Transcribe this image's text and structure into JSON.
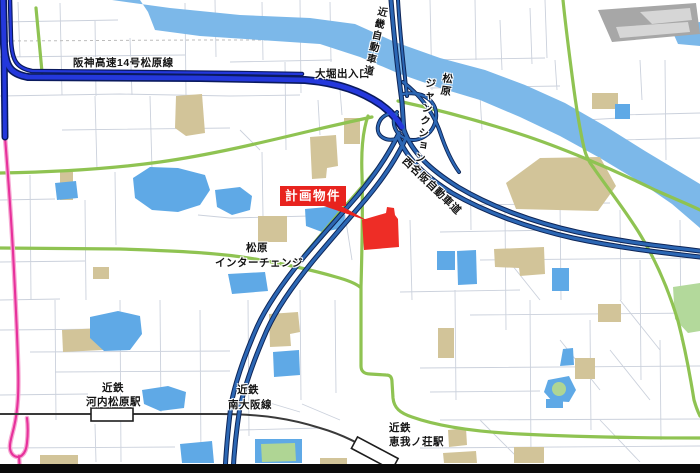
{
  "meta": {
    "width": 700,
    "height": 473,
    "description": "計画物件位置図 松原ジャンクション周辺地図"
  },
  "palette": {
    "street": "#CBD1DC",
    "boundary": "#BDBDBD",
    "river": "#7CB8E9",
    "pond": "#5FA9E6",
    "park": "#B3D99B",
    "building_tan": "#D2C499",
    "building_gray": "#A7A7A7",
    "road_green": "#8FC352",
    "rail": "#3A3A3A",
    "pink_casing": "#F6ABD4",
    "pink_core": "#E7309B",
    "expwy_casing": "#0E2557",
    "expwy_fill": "#2C67B4",
    "hanshin_casing": "#0A1A5E",
    "hanshin_fill": "#2438DC",
    "property_red": "#EE2D26",
    "callout_red": "#E8231E",
    "bottom_bar": "#0A0A0A"
  },
  "callout": {
    "text": "計画物件"
  },
  "map": {
    "labels": [
      {
        "name": "hanshin-route-label",
        "text": "阪神高速14号松原線",
        "x": 73,
        "y": 57,
        "size": 10.5
      },
      {
        "name": "ohori-exit-label",
        "text": "大堀出入口",
        "x": 315,
        "y": 68,
        "size": 10.5
      },
      {
        "name": "kinki-expressway-label",
        "text": "近畿自動車道",
        "x": 376,
        "y": 5,
        "size": 10,
        "rot": 13,
        "cls": "vert"
      },
      {
        "name": "matsubara-junction-label-line1",
        "text": "松原",
        "x": 442,
        "y": 72,
        "size": 10.5,
        "rot": 8,
        "cls": "vert"
      },
      {
        "name": "matsubara-junction-label-line2",
        "text": "ジャンクション",
        "x": 425,
        "y": 77,
        "size": 10.5,
        "rot": 8,
        "cls": "vert"
      },
      {
        "name": "nishimeihan-expressway-label",
        "text": "西名阪自動車道",
        "x": 408,
        "y": 155,
        "size": 10.5,
        "rot": 44
      },
      {
        "name": "matsubara-ic-label-line1",
        "text": "松原",
        "x": 246,
        "y": 242,
        "size": 10.5
      },
      {
        "name": "matsubara-ic-label-line2",
        "text": "インターチェンジ",
        "x": 215,
        "y": 257,
        "size": 10.5
      },
      {
        "name": "kintetsu-kawachi-label-line1",
        "text": "近鉄",
        "x": 102,
        "y": 382,
        "size": 10.5
      },
      {
        "name": "kintetsu-kawachi-label-line2",
        "text": "河内松原駅",
        "x": 86,
        "y": 396,
        "size": 10.5
      },
      {
        "name": "minami-osaka-line-label-line1",
        "text": "近鉄",
        "x": 237,
        "y": 384,
        "size": 10.5
      },
      {
        "name": "minami-osaka-line-label-line2",
        "text": "南大阪線",
        "x": 228,
        "y": 399,
        "size": 10.5
      },
      {
        "name": "kintetsu-eganosho-label-line1",
        "text": "近鉄",
        "x": 389,
        "y": 422,
        "size": 10.5
      },
      {
        "name": "kintetsu-eganosho-label-line2",
        "text": "恵我ノ荘駅",
        "x": 389,
        "y": 436,
        "size": 10.5
      }
    ],
    "layers": [
      {
        "name": "street-grid",
        "attrs": {
          "stroke": "#CBD1DC",
          "stroke-width": "0.9",
          "fill": "none"
        },
        "shapes": [
          {
            "d": "M18,2 L20,57 M60,3 L62,95 M95,20 L96,96 M130,38 L132,95 M185,3 L186,95 M215,0 L216,57 M0,22 L118,20 M0,57 L185,55 M0,96 L120,94 L230,96 M62,130 L230,128 M95,96 L97,170 M150,96 L152,170 M230,25 L330,24 M262,2 L263,60 M300,0 L301,93 M230,62 L332,60 M330,2 L331,62 M230,96 L300,95"
          },
          {
            "d": "M0,200 L55,199 M30,175 L31,300 M85,200 L86,300 M0,262 L85,261 M115,172 L116,245 M0,300 L60,299 M230,218 L310,216 M262,152 L263,217 M285,62 L286,150 M198,215 L230,218 M240,130 L260,150"
          },
          {
            "d": "M0,330 L120,329 M55,300 L56,420 M120,300 L121,462 M30,352 L230,351 M160,300 L161,412 M55,372 L230,371 M0,395 L88,394 M200,310 L201,462 M0,448 L175,447 M95,424 L96,462 M248,300 L249,436 M240,430 L320,428 M302,404 L340,420 M260,400 L300,412"
          },
          {
            "d": "M300,290 L301,400 M335,300 L336,393 M345,215 L352,260 M410,220 L412,300 M340,90 L342,115 M318,100 L320,135"
          },
          {
            "d": "M420,60 L545,58 M430,0 L432,90 M475,0 L476,60 M430,88 L560,86 M530,8 L532,64 M500,20 L502,70 M545,0 L547,58 M620,115 L700,113 M665,60 L666,160 M620,140 L700,138 M585,120 L620,118 M480,95 L482,130 M555,60 L557,90 M640,60 L642,100"
          },
          {
            "d": "M470,130 L471,230 M505,210 L506,330 M470,205 L610,203 M440,232 L560,230 M560,200 L561,300 M480,260 L700,258 M620,210 L621,300 M400,292 L520,290 M470,315 L700,313 M455,290 L456,400 M640,260 L641,380 M680,220 L681,340 M590,320 L591,430 M530,300 L531,460"
          },
          {
            "d": "M420,368 L700,366 M430,392 L540,391 M440,420 L700,419 M420,448 L700,446 M660,340 L661,440 M500,250 L540,300 M560,340 L600,390 M620,300 L660,350 M480,420 L520,460 M600,420 L640,462 M610,350 L650,400"
          }
        ]
      },
      {
        "name": "boundary-line",
        "attrs": {
          "stroke": "#BDBDBD",
          "stroke-width": "1",
          "fill": "none"
        },
        "shapes": [
          {
            "d": "M0,41 L200,40 L356,40",
            "stroke-dasharray": "3 3"
          }
        ]
      },
      {
        "name": "river",
        "attrs": {
          "fill": "#7CB8E9",
          "stroke": "none"
        },
        "shapes": [
          {
            "d": "M112,0 L170,8 L240,15 L310,18 L355,24 L395,42 L440,58 L485,70 L525,85 L565,103 L605,126 L645,151 L680,172 L700,184 L700,228 L672,204 L640,182 L600,158 L560,136 L520,117 L480,100 L440,88 L400,74 L360,57 L320,44 L260,40 L200,36 L155,30 L148,12 L140,0 Z"
          },
          {
            "d": "M670,26 L700,22 L700,46 L678,44 Z"
          }
        ]
      },
      {
        "name": "park-areas",
        "attrs": {
          "fill": "#B3D99B",
          "stroke": "none"
        },
        "shapes": [
          {
            "d": "M673,287 L700,283 L700,331 L688,333 L675,319 Z"
          }
        ]
      },
      {
        "name": "buildings-tan",
        "attrs": {
          "fill": "#D2C499",
          "stroke": "none"
        },
        "shapes": [
          {
            "d": "M176,96 L202,94 L205,133 L186,136 L175,128 Z"
          },
          {
            "t": "rect",
            "x": 60,
            "y": 172,
            "width": 13,
            "height": 28
          },
          {
            "d": "M310,137 L336,135 L338,166 L327,168 L326,178 L312,179 Z"
          },
          {
            "t": "rect",
            "x": 344,
            "y": 118,
            "width": 16,
            "height": 26
          },
          {
            "t": "rect",
            "x": 592,
            "y": 93,
            "width": 26,
            "height": 16
          },
          {
            "d": "M506,183 L540,158 L600,157 L616,186 L598,211 L516,209 Z"
          },
          {
            "t": "rect",
            "x": 93,
            "y": 267,
            "width": 16,
            "height": 12
          },
          {
            "d": "M62,330 L102,328 L103,350 L63,352 Z"
          },
          {
            "d": "M269,314 L298,312 L300,332 L290,334 L291,346 L270,347 Z"
          },
          {
            "t": "rect",
            "x": 40,
            "y": 455,
            "width": 38,
            "height": 9
          },
          {
            "d": "M448,430 L466,428 L467,445 L449,447 Z"
          },
          {
            "t": "rect",
            "x": 514,
            "y": 447,
            "width": 30,
            "height": 16
          },
          {
            "d": "M443,453 L476,451 L477,463 L444,463 Z"
          },
          {
            "d": "M494,249 L544,247 L545,274 L520,276 L519,268 L495,267 Z"
          },
          {
            "t": "rect",
            "x": 598,
            "y": 304,
            "width": 23,
            "height": 18
          },
          {
            "t": "rect",
            "x": 438,
            "y": 328,
            "width": 16,
            "height": 30
          },
          {
            "t": "rect",
            "x": 575,
            "y": 358,
            "width": 20,
            "height": 21
          },
          {
            "t": "rect",
            "x": 320,
            "y": 458,
            "width": 27,
            "height": 6
          },
          {
            "t": "rect",
            "x": 258,
            "y": 216,
            "width": 29,
            "height": 26
          }
        ]
      },
      {
        "name": "factory-building",
        "attrs": {
          "stroke": "none"
        },
        "shapes": [
          {
            "d": "M598,10 L696,3 L700,34 L612,42 Z",
            "fill": "#A7A7A7"
          },
          {
            "d": "M640,12 L690,8 L692,20 L652,24 Z",
            "fill": "#D6D6D6"
          },
          {
            "d": "M616,27 L688,22 L690,32 L620,38 Z",
            "fill": "#D6D6D6"
          }
        ]
      },
      {
        "name": "ponds",
        "attrs": {
          "fill": "#5FA9E6",
          "stroke": "none"
        },
        "shapes": [
          {
            "d": "M133,178 L150,167 L178,168 L205,175 L210,190 L200,205 L178,212 L152,210 L135,198 Z"
          },
          {
            "d": "M215,190 L240,187 L252,196 L250,210 L232,215 L217,207 Z"
          },
          {
            "d": "M55,183 L76,181 L78,198 L57,200 Z"
          },
          {
            "d": "M305,209 L338,206 L345,215 L344,228 L322,232 L306,226 Z"
          },
          {
            "d": "M90,317 L118,311 L140,316 L142,334 L130,350 L104,351 L90,338 Z"
          },
          {
            "d": "M142,390 L168,386 L186,392 L184,408 L160,411 L144,404 Z"
          },
          {
            "d": "M228,274 L265,272 L268,291 L232,294 Z"
          },
          {
            "d": "M273,352 L299,350 L300,375 L274,377 Z"
          },
          {
            "d": "M180,444 L212,441 L214,463 L182,463 Z"
          },
          {
            "t": "rect",
            "x": 255,
            "y": 439,
            "width": 47,
            "height": 24
          },
          {
            "t": "rect",
            "x": 437,
            "y": 251,
            "width": 18,
            "height": 19
          },
          {
            "d": "M457,251 L476,250 L477,284 L458,285 Z"
          },
          {
            "t": "rect",
            "x": 552,
            "y": 268,
            "width": 17,
            "height": 23
          },
          {
            "d": "M563,349 L573,348 L574,365 L560,366 Z"
          },
          {
            "d": "M548,380 L569,376 L576,390 L569,402 L552,401 L544,392 Z"
          },
          {
            "t": "rect",
            "x": 615,
            "y": 104,
            "width": 15,
            "height": 15
          },
          {
            "t": "rect",
            "x": 546,
            "y": 399,
            "width": 17,
            "height": 9
          }
        ]
      },
      {
        "name": "pond-islands",
        "attrs": {
          "fill": "#AFD594",
          "stroke": "none"
        },
        "shapes": [
          {
            "d": "M261,444 L295,443 L296,461 L262,462 Z"
          },
          {
            "t": "circle",
            "cx": 559,
            "cy": 389,
            "r": 7
          }
        ]
      },
      {
        "name": "green-roads",
        "attrs": {
          "stroke": "#8FC352",
          "stroke-width": "3.2",
          "fill": "none",
          "stroke-linecap": "round"
        },
        "shapes": [
          {
            "d": "M0,173 C60,172 110,169 160,162 C210,155 260,143 310,131 C340,124 358,120 372,117"
          },
          {
            "d": "M398,101 C440,110 480,121 520,134 C560,147 610,168 655,190 C675,199 690,205 700,210"
          },
          {
            "d": "M563,0 C566,30 570,60 574,90 C577,112 580,130 584,148 C586,156 589,162 593,167"
          },
          {
            "d": "M593,167 C606,186 626,211 641,236 C656,261 669,291 678,321 C685,348 690,375 694,400 C696,407 698,412 700,416"
          },
          {
            "d": "M0,248 L120,249 C180,251 220,253 255,259 C285,264 312,270 336,277 C347,280 355,283 360,287"
          },
          {
            "d": "M368,116 C363,130 361,150 362,175 C363,210 362,250 361,287 L361,366 C361,371 364,374 370,374 L386,375 C390,375 392,377 392,382 L393,398 C394,408 400,413 412,417 C440,427 480,432 520,434 C580,437 640,438 700,438"
          },
          {
            "d": "M384,160 C370,178 352,198 335,218 C325,230 314,243 304,255"
          },
          {
            "d": "M36,8 C38,30 40,50 42,72"
          }
        ]
      },
      {
        "name": "pink-route",
        "attrs": {
          "fill": "none",
          "stroke-linecap": "round"
        },
        "shapes": [
          {
            "d": "M5,137 C8,175 11,215 13,252 C15,290 17,328 18,362 C19,392 18,410 14,427 C11,440 7,449 13,455 C19,460 26,455 27,443 C28,434 28,426 27,418 M19,456 L20,473",
            "stroke": "#F6ABD4",
            "stroke-width": "4.6"
          },
          {
            "d": "M5,137 C8,175 11,215 13,252 C15,290 17,328 18,362 C19,392 18,410 14,427 C11,440 7,449 13,455 C19,460 26,455 27,443 C28,434 28,426 27,418 M19,456 L20,473",
            "stroke": "#E7309B",
            "stroke-width": "2.1"
          }
        ]
      },
      {
        "name": "railway-minami-osaka-line",
        "attrs": {
          "fill": "none"
        },
        "shapes": [
          {
            "d": "M0,414 L220,414 C262,414 292,419 320,428 C348,436 370,449 389,463 L398,471",
            "stroke": "#3A3A3A",
            "stroke-width": "2"
          },
          {
            "t": "rect",
            "x": 91,
            "y": 408,
            "width": 42,
            "height": 13,
            "fill": "#FFFFFF",
            "stroke": "#1D1D1D",
            "stroke-width": "1.6"
          },
          {
            "t": "rect",
            "x": 352,
            "y": 447,
            "width": 46,
            "height": 13,
            "fill": "#FFFFFF",
            "stroke": "#1D1D1D",
            "stroke-width": "1.6",
            "transform": "rotate(28 375 453)"
          }
        ]
      },
      {
        "name": "expressway-casings",
        "attrs": {
          "fill": "none",
          "stroke-linecap": "round",
          "stroke-linejoin": "round"
        },
        "shapes": [
          {
            "d": "M391,0 C394,38 398,72 402,102 L404,132",
            "stroke": "#0E2557",
            "stroke-width": "5"
          },
          {
            "d": "M398,0 C400,36 404,68 407,96",
            "stroke": "#0E2557",
            "stroke-width": "4"
          },
          {
            "d": "M404,130 C412,153 431,170 458,187 C490,206 532,222 577,232 C623,242 666,247 700,251",
            "stroke": "#0E2557",
            "stroke-width": "5"
          },
          {
            "d": "M398,136 C406,158 425,176 452,193 C485,212 528,228 573,238 C620,248 664,253 700,257",
            "stroke": "#0E2557",
            "stroke-width": "5"
          },
          {
            "d": "M399,133 C388,156 374,176 357,196 C338,218 318,240 303,258 C285,280 268,303 257,327 C246,352 236,378 231,405 C228,430 226,450 225,473",
            "stroke": "#0E2557",
            "stroke-width": "5"
          },
          {
            "d": "M406,138 C396,160 382,180 366,199 C347,221 328,243 313,261 C295,283 278,306 267,330 C256,355 246,381 240,407 C236,432 234,452 233,473",
            "stroke": "#0E2557",
            "stroke-width": "5"
          },
          {
            "d": "M403,94 C425,90 438,103 436,118 C434,134 419,143 407,139 C395,135 390,122 397,112",
            "stroke": "#0E2557",
            "stroke-width": "4"
          },
          {
            "d": "M399,138 C386,143 376,136 378,126 C380,116 390,111 397,115",
            "stroke": "#0E2557",
            "stroke-width": "4"
          },
          {
            "d": "M338,85 C360,91 378,100 391,111",
            "stroke": "#0E2557",
            "stroke-width": "4"
          },
          {
            "d": "M403,82 C420,95 433,112 440,132 C445,147 451,161 459,172",
            "stroke": "#0E2557",
            "stroke-width": "4"
          },
          {
            "d": "M3,0 L4,44 C5,66 10,74 28,77 L200,78 L305,80 C340,83 362,92 380,104 C390,111 397,119 402,127",
            "stroke": "#0A1A5E",
            "stroke-width": "8"
          },
          {
            "d": "M10,0 L11,40 C12,60 16,68 32,71 L240,73 L302,74",
            "stroke": "#0A1A5E",
            "stroke-width": "4.5"
          },
          {
            "d": "M4,44 L5,137",
            "stroke": "#0A1A5E",
            "stroke-width": "7"
          }
        ]
      },
      {
        "name": "expressway-fills",
        "attrs": {
          "fill": "none",
          "stroke-linecap": "round",
          "stroke-linejoin": "round"
        },
        "shapes": [
          {
            "d": "M391,0 C394,38 398,72 402,102 L404,132",
            "stroke": "#2C67B4",
            "stroke-width": "3"
          },
          {
            "d": "M398,0 C400,36 404,68 407,96",
            "stroke": "#2C67B4",
            "stroke-width": "2"
          },
          {
            "d": "M404,130 C412,153 431,170 458,187 C490,206 532,222 577,232 C623,242 666,247 700,251",
            "stroke": "#2C67B4",
            "stroke-width": "3"
          },
          {
            "d": "M398,136 C406,158 425,176 452,193 C485,212 528,228 573,238 C620,248 664,253 700,257",
            "stroke": "#2C67B4",
            "stroke-width": "3"
          },
          {
            "d": "M399,133 C388,156 374,176 357,196 C338,218 318,240 303,258 C285,280 268,303 257,327 C246,352 236,378 231,405 C228,430 226,450 225,473",
            "stroke": "#2C67B4",
            "stroke-width": "3"
          },
          {
            "d": "M406,138 C396,160 382,180 366,199 C347,221 328,243 313,261 C295,283 278,306 267,330 C256,355 246,381 240,407 C236,432 234,452 233,473",
            "stroke": "#2C67B4",
            "stroke-width": "3"
          },
          {
            "d": "M403,94 C425,90 438,103 436,118 C434,134 419,143 407,139 C395,135 390,122 397,112",
            "stroke": "#2C67B4",
            "stroke-width": "2.2"
          },
          {
            "d": "M399,138 C386,143 376,136 378,126 C380,116 390,111 397,115",
            "stroke": "#2C67B4",
            "stroke-width": "2.2"
          },
          {
            "d": "M338,85 C360,91 378,100 391,111",
            "stroke": "#2C67B4",
            "stroke-width": "2.2"
          },
          {
            "d": "M403,82 C420,95 433,112 440,132 C445,147 451,161 459,172",
            "stroke": "#2C67B4",
            "stroke-width": "2.2"
          },
          {
            "d": "M3,0 L4,44 C5,66 10,74 28,77 L200,78 L305,80 C340,83 362,92 380,104 C390,111 397,119 402,127",
            "stroke": "#2438DC",
            "stroke-width": "4.8"
          },
          {
            "d": "M10,0 L11,40 C12,60 16,68 32,71 L240,73 L302,74",
            "stroke": "#2438DC",
            "stroke-width": "2.2"
          },
          {
            "d": "M4,44 L5,137",
            "stroke": "#2438DC",
            "stroke-width": "4"
          }
        ]
      },
      {
        "name": "property-parcel",
        "attrs": {
          "stroke": "none"
        },
        "shapes": [
          {
            "d": "M362,220 L386,213 L387,207 L394,208 L395,215 L398,219 L399,247 L364,250 Z",
            "fill": "#EE2D26"
          },
          {
            "d": "M318,204 L338,204 L368,221 Z",
            "fill": "#E8231E"
          }
        ]
      },
      {
        "name": "bottom-black-bar",
        "attrs": {
          "stroke": "none"
        },
        "shapes": [
          {
            "t": "rect",
            "x": 0,
            "y": 464,
            "width": 700,
            "height": 9,
            "fill": "#0A0A0A"
          }
        ]
      }
    ]
  }
}
